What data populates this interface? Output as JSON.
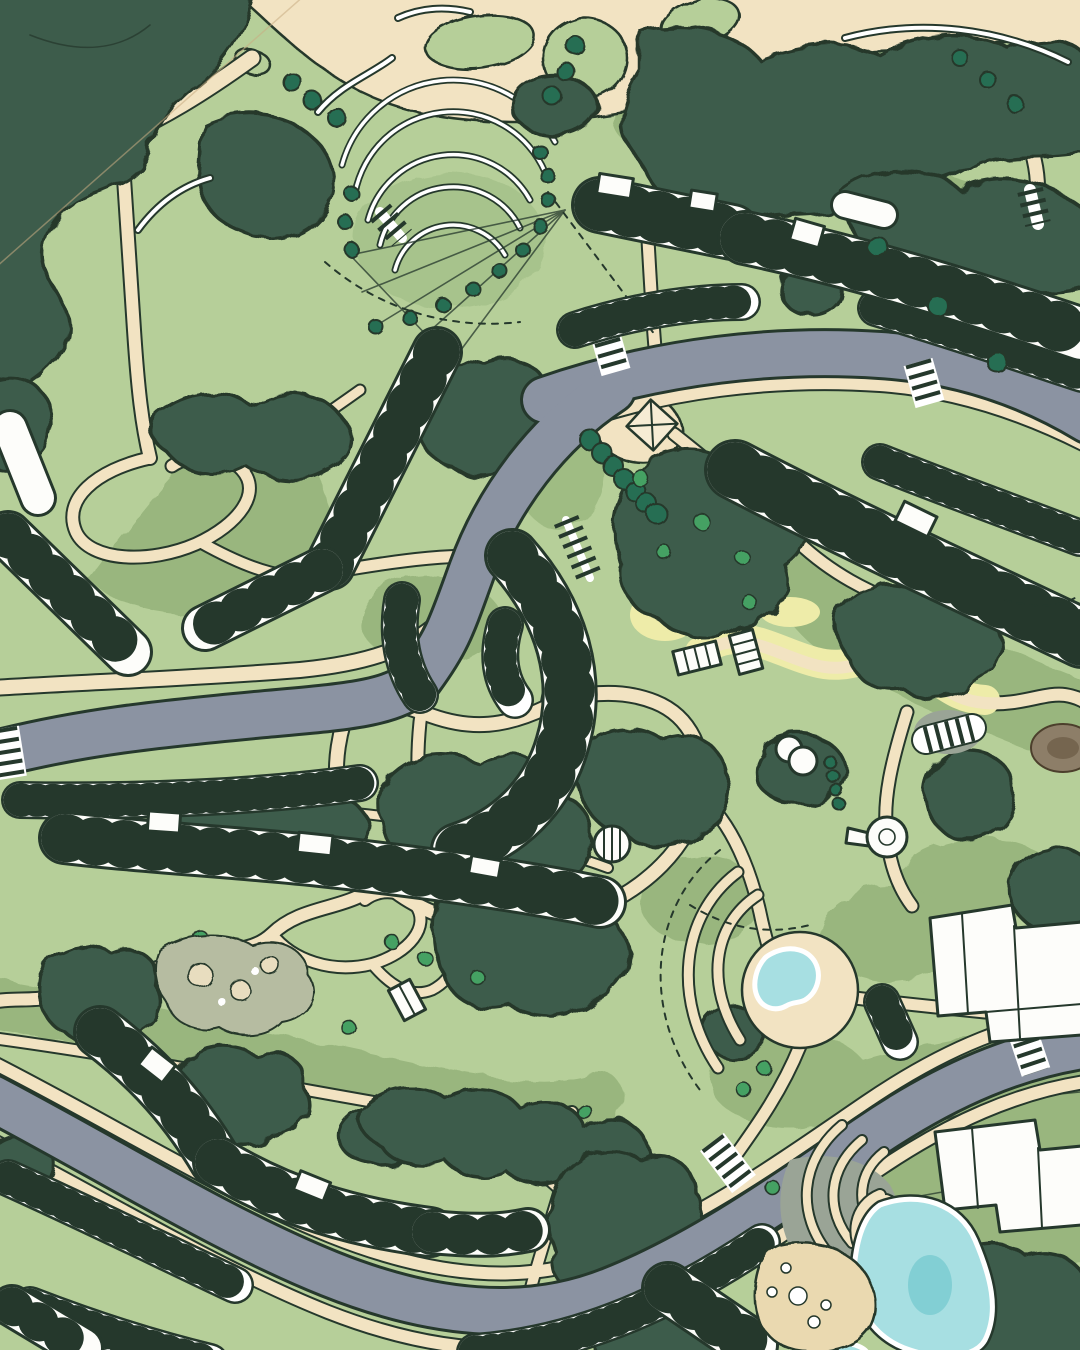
{
  "scene": {
    "title": "Illustrated landscape masterplan — aerial site plan",
    "view": "top-down plan rendering",
    "visible_text": "none"
  },
  "palette": {
    "lawn": "#b6cf99",
    "lawnMed": "#96b47b",
    "forest": "#3e5c4b",
    "tree": "#256e52",
    "shrub": "#45a163",
    "line": "#25382c",
    "tan": "#f2e3c2",
    "tanLight": "#f7ecd4",
    "yellow": "#eeeca9",
    "road": "#8b93a2",
    "bldg": "#fdfdfa",
    "pool": "#a7dfe2",
    "poolDeep": "#82cfd4",
    "beach": "#ead9b0",
    "paving": "#9aa496",
    "rock": "#b6bca1",
    "pebble": "#e8ddbf",
    "mound": "#8d7e68",
    "moundCore": "#75654f",
    "wire": "#c9ad83",
    "white": "#ffffff"
  },
  "features": {
    "roads": "three sweeping grey loop roads with zebra crossings",
    "parking": "perpendicular-stall parking bands flanking the roads",
    "buildings": "long white stepped residential slabs",
    "park": "central informal park with winding tan footpaths",
    "landmarks": "amphitheatre terraces, grand stair, white dome pavilions, round pond plaza, swimming pool with beach",
    "planting": "dark evergreen canopy masses, round specimen trees, bright shrubs"
  }
}
